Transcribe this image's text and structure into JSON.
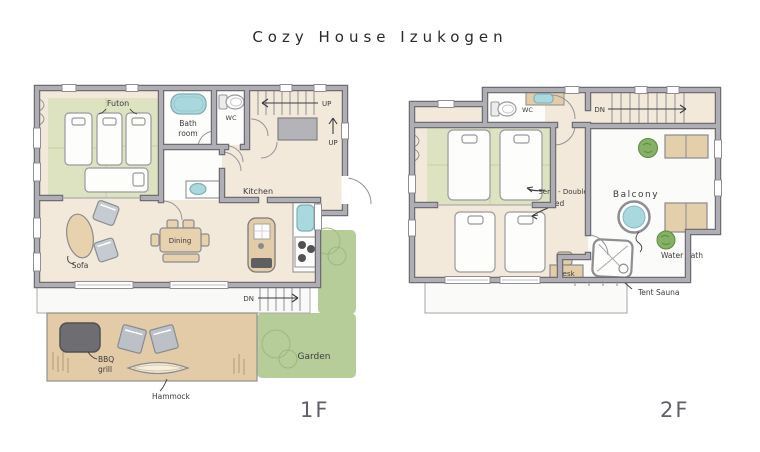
{
  "title": "Cozy House Izukogen",
  "floor1": {
    "label": "1F",
    "futon": "Futon",
    "bath_line1": "Bath",
    "bath_line2": "room",
    "wc": "WC",
    "up_stairs": "UP",
    "up_entry": "UP",
    "kitchen": "Kitchen",
    "dining": "Dining",
    "sofa": "Sofa",
    "dn": "DN",
    "garden": "Garden",
    "bbq_line1": "BBQ",
    "bbq_line2": "grill",
    "hammock": "Hammock"
  },
  "floor2": {
    "label": "2F",
    "wc": "WC",
    "dn": "DN",
    "semi_double_line1": "Semi - Double",
    "semi_double_line2": "Bed",
    "balcony": "Balcony",
    "desk": "Desk",
    "water_bath": "Water Bath",
    "tent_sauna": "Tent Sauna"
  },
  "colors": {
    "tatami": "#dde3c1",
    "floor": "#f2e9da",
    "deck": "#e2cba6",
    "garden": "#b7cd99",
    "water": "#a9d8de",
    "wall_light": "#aeaeb4",
    "wall_dark": "#6d6d73",
    "ink": "#3b3b40"
  }
}
